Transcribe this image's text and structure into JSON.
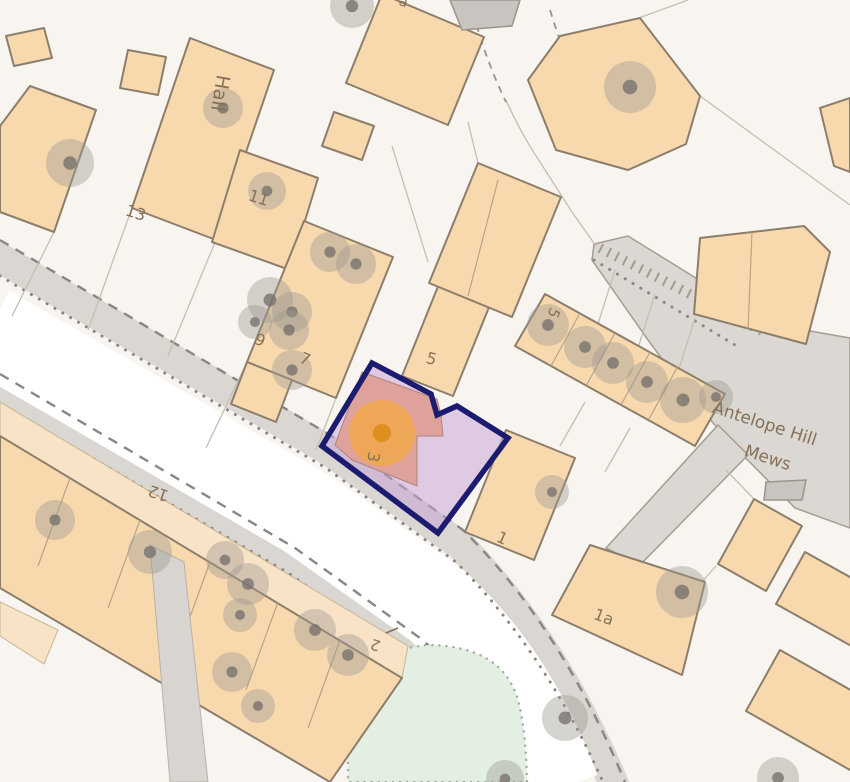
{
  "map": {
    "type": "property-location-map",
    "street_name": "Antelope Hill Mews",
    "colors": {
      "background": "#f8f5f0",
      "building_fill": "#f8d9ae",
      "building_stroke": "#8d7e6b",
      "garden_fill": "#f8e3c6",
      "gray_building": "#c9c4bf",
      "road_surface": "#ffffff",
      "sidewalk": "#dad6d1",
      "road_edge_dash": "#8b8681",
      "green_area": "#e2efe2",
      "plot_outline": "#1b1b6f",
      "plot_fill": "rgba(197,165,214,0.52)",
      "plot_building": "#dfa19b",
      "marker_outer": "#f3a93c",
      "marker_inner": "#df8f1d",
      "label_color": "#857257"
    },
    "marker": {
      "cx": 382,
      "cy": 433,
      "outer_r": 33,
      "inner_r": 9
    },
    "highlight_plot": {
      "outline_points": "372,363 431,394 437,415 457,406 508,438 438,533 322,446",
      "building_points": "362,372 437,399 441,415 443,436 417,436 417,486 352,460 335,445"
    },
    "labels": [
      {
        "text": "Hall",
        "x": 214,
        "y": 92,
        "rot": 100,
        "size": 19,
        "color": "#6d6963"
      },
      {
        "text": "13",
        "x": 134,
        "y": 218,
        "rot": 18,
        "size": 16,
        "color": "#857257"
      },
      {
        "text": "11",
        "x": 257,
        "y": 203,
        "rot": 18,
        "size": 16,
        "color": "#857257"
      },
      {
        "text": "9",
        "x": 258,
        "y": 345,
        "rot": 22,
        "size": 16,
        "color": "#857257"
      },
      {
        "text": "7",
        "x": 303,
        "y": 364,
        "rot": 22,
        "size": 16,
        "color": "#857257"
      },
      {
        "text": "5",
        "x": 430,
        "y": 364,
        "rot": 15,
        "size": 16,
        "color": "#857257"
      },
      {
        "text": "5",
        "x": 549,
        "y": 311,
        "rot": 112,
        "size": 15,
        "color": "#857257"
      },
      {
        "text": "3",
        "x": 368,
        "y": 456,
        "rot": 100,
        "size": 16,
        "color": "#7c6652"
      },
      {
        "text": "1",
        "x": 500,
        "y": 543,
        "rot": 25,
        "size": 16,
        "color": "#857257"
      },
      {
        "text": "1a",
        "x": 602,
        "y": 622,
        "rot": 20,
        "size": 16,
        "color": "#857257"
      },
      {
        "text": "12",
        "x": 160,
        "y": 488,
        "rot": 198,
        "size": 16,
        "color": "#857257"
      },
      {
        "text": "2",
        "x": 377,
        "y": 640,
        "rot": 198,
        "size": 15,
        "color": "#857257"
      },
      {
        "text": "a",
        "x": 402,
        "y": 6,
        "rot": 20,
        "size": 14,
        "color": "#857257"
      },
      {
        "text": "Antelope Hill",
        "x": 763,
        "y": 429,
        "rot": 18,
        "size": 17,
        "color": "#6f6a63"
      },
      {
        "text": "Mews",
        "x": 766,
        "y": 463,
        "rot": 18,
        "size": 17,
        "color": "#6f6a63"
      }
    ],
    "trees": [
      [
        70,
        163,
        24
      ],
      [
        223,
        108,
        20
      ],
      [
        267,
        191,
        19
      ],
      [
        352,
        6,
        22
      ],
      [
        630,
        87,
        26
      ],
      [
        330,
        252,
        20
      ],
      [
        356,
        264,
        20
      ],
      [
        270,
        300,
        23
      ],
      [
        292,
        312,
        20
      ],
      [
        255,
        322,
        17
      ],
      [
        289,
        330,
        20
      ],
      [
        292,
        370,
        20
      ],
      [
        548,
        325,
        21
      ],
      [
        585,
        347,
        21
      ],
      [
        613,
        363,
        21
      ],
      [
        647,
        382,
        21
      ],
      [
        683,
        400,
        23
      ],
      [
        716,
        397,
        17
      ],
      [
        552,
        492,
        17
      ],
      [
        682,
        592,
        26
      ],
      [
        565,
        718,
        23
      ],
      [
        505,
        779,
        19
      ],
      [
        778,
        778,
        21
      ],
      [
        55,
        520,
        20
      ],
      [
        150,
        552,
        22
      ],
      [
        225,
        560,
        19
      ],
      [
        248,
        584,
        21
      ],
      [
        240,
        615,
        17
      ],
      [
        315,
        630,
        21
      ],
      [
        348,
        655,
        21
      ],
      [
        232,
        672,
        20
      ],
      [
        258,
        706,
        17
      ]
    ]
  }
}
